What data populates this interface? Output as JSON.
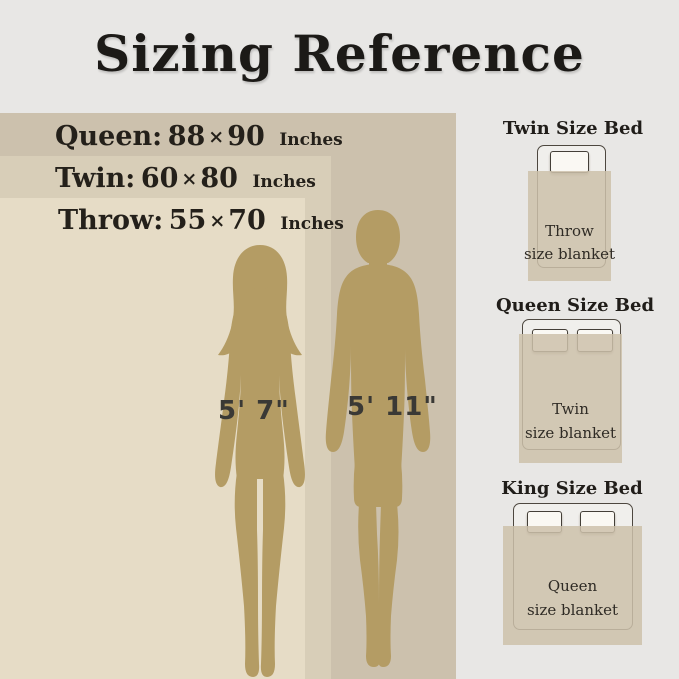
{
  "title": "Sizing Reference",
  "size_rows": [
    {
      "id": "queen",
      "label": "Queen:",
      "width_in": "88",
      "times": "×",
      "height_in": "90",
      "unit": "Inches"
    },
    {
      "id": "twin",
      "label": "Twin:",
      "width_in": "60",
      "times": "×",
      "height_in": "80",
      "unit": "Inches"
    },
    {
      "id": "throw",
      "label": "Throw:",
      "width_in": "55",
      "times": "×",
      "height_in": "70",
      "unit": "Inches"
    }
  ],
  "figures": [
    {
      "id": "woman",
      "height_label": "5' 7\""
    },
    {
      "id": "man",
      "height_label": "5' 11\""
    }
  ],
  "beds": [
    {
      "id": "twin-bed",
      "title": "Twin Size Bed",
      "blanket_line1": "Throw",
      "blanket_line2": "size blanket"
    },
    {
      "id": "queen-bed",
      "title": "Queen Size Bed",
      "blanket_line1": "Twin",
      "blanket_line2": "size blanket"
    },
    {
      "id": "king-bed",
      "title": "King Size Bed",
      "blanket_line1": "Queen",
      "blanket_line2": "size blanket"
    }
  ],
  "colors": {
    "background": "#e8e7e5",
    "queen_rect": "#ccc1ad",
    "twin_rect": "#d8ceb8",
    "throw_rect": "#e6dcc6",
    "silhouette": "#b49c64",
    "bed_blanket": "#cdc1aa",
    "outline": "#4d473f",
    "text_dark": "#24201a"
  }
}
